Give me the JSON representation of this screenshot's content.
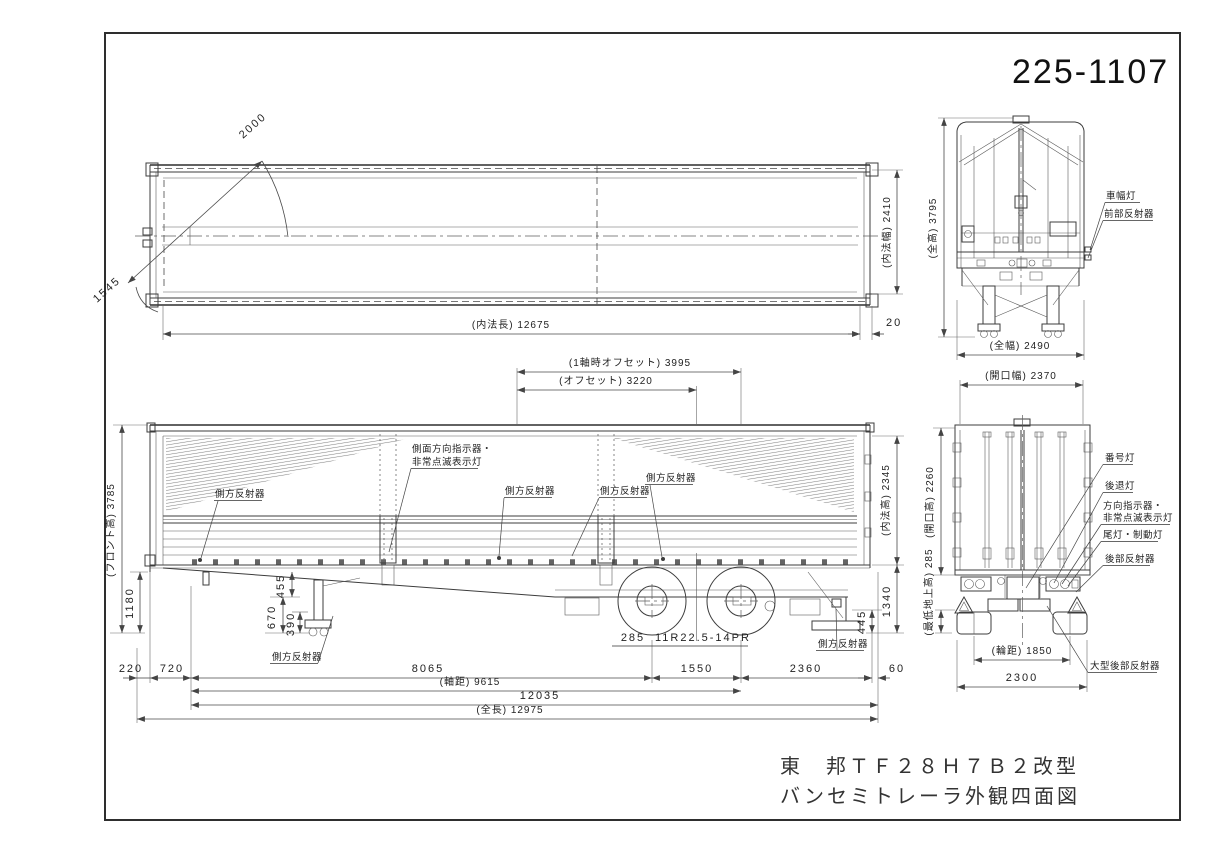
{
  "title": {
    "drawing_number": "225-1107",
    "model_line": "東　邦ＴＦ２８Ｈ７Ｂ２改型",
    "name_line": "バンセミトレーラ外観四面図"
  },
  "colors": {
    "line": "#3c3c3c",
    "paper": "#ffffff"
  },
  "plan_view": {
    "dims": {
      "radius_front": "2000",
      "radius_rear": "1545",
      "inner_length": "(内法長) 12675",
      "inner_width": "(内法幅) 2410",
      "rear_gap": "20"
    }
  },
  "front_view": {
    "dims": {
      "overall_height": "(全高) 3795",
      "overall_width": "(全幅) 2490"
    },
    "labels": {
      "clearance_lamp": "車幅灯",
      "front_reflector": "前部反射器"
    }
  },
  "side_view": {
    "dims": {
      "offset_single_axle": "(1軸時オフセット) 3995",
      "offset": "(オフセット) 3220",
      "front_height": "(フロント高) 3785",
      "inner_height": "(内法高) 2345",
      "front_frame_height": "1180",
      "h455": "455",
      "h670": "670",
      "h390": "390",
      "rear_floor_height": "1340",
      "guard_height": "445",
      "front_overhang": "220",
      "kingpin_setback": "720",
      "kingpin_to_axle1": "8065",
      "wheelbase": "(軸距) 9615",
      "kingpin_to_rear": "12035",
      "overall_length": "(全長) 12975",
      "axle_spread": "1550",
      "axle_to_rear": "2360",
      "rear_gap": "60",
      "tire_width": "285",
      "tire_size": "11R22.5-14PR"
    },
    "labels": {
      "side_reflector": "側方反射器",
      "side_turn_signal_1": "側面方向指示器・",
      "side_turn_signal_2": "非常点滅表示灯"
    }
  },
  "rear_view": {
    "dims": {
      "opening_width": "(開口幅) 2370",
      "opening_height": "(開口高) 2260",
      "min_ground_clearance": "(最低地上高) 285",
      "track": "(輪距) 1850",
      "rear_overall_width": "2300"
    },
    "labels": {
      "number_plate_lamp": "番号灯",
      "reverse_lamp": "後退灯",
      "turn_signal_1": "方向指示器・",
      "turn_signal_2": "非常点滅表示灯",
      "tail_brake_lamp": "尾灯・制動灯",
      "rear_reflector": "後部反射器",
      "large_rear_reflector": "大型後部反射器"
    }
  }
}
